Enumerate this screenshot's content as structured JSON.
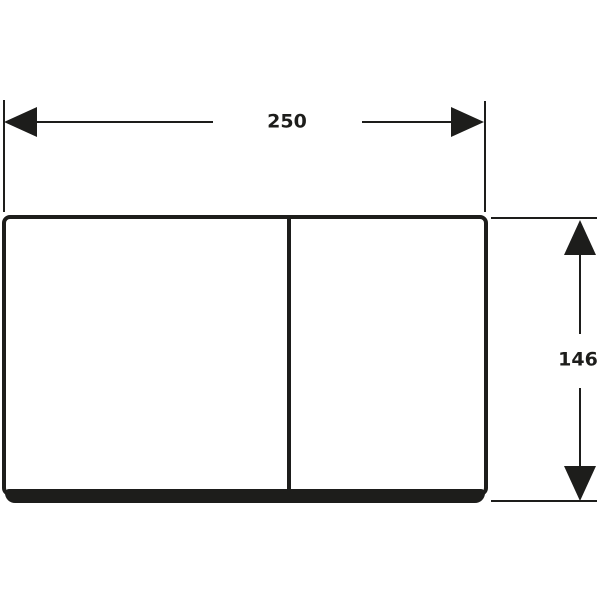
{
  "drawing": {
    "background_color": "#ffffff",
    "line_color": "#1d1d1b",
    "subject": "rectangular-plate-front-view",
    "dimensions": {
      "width": {
        "value": "250"
      },
      "height": {
        "value": "146"
      }
    }
  }
}
